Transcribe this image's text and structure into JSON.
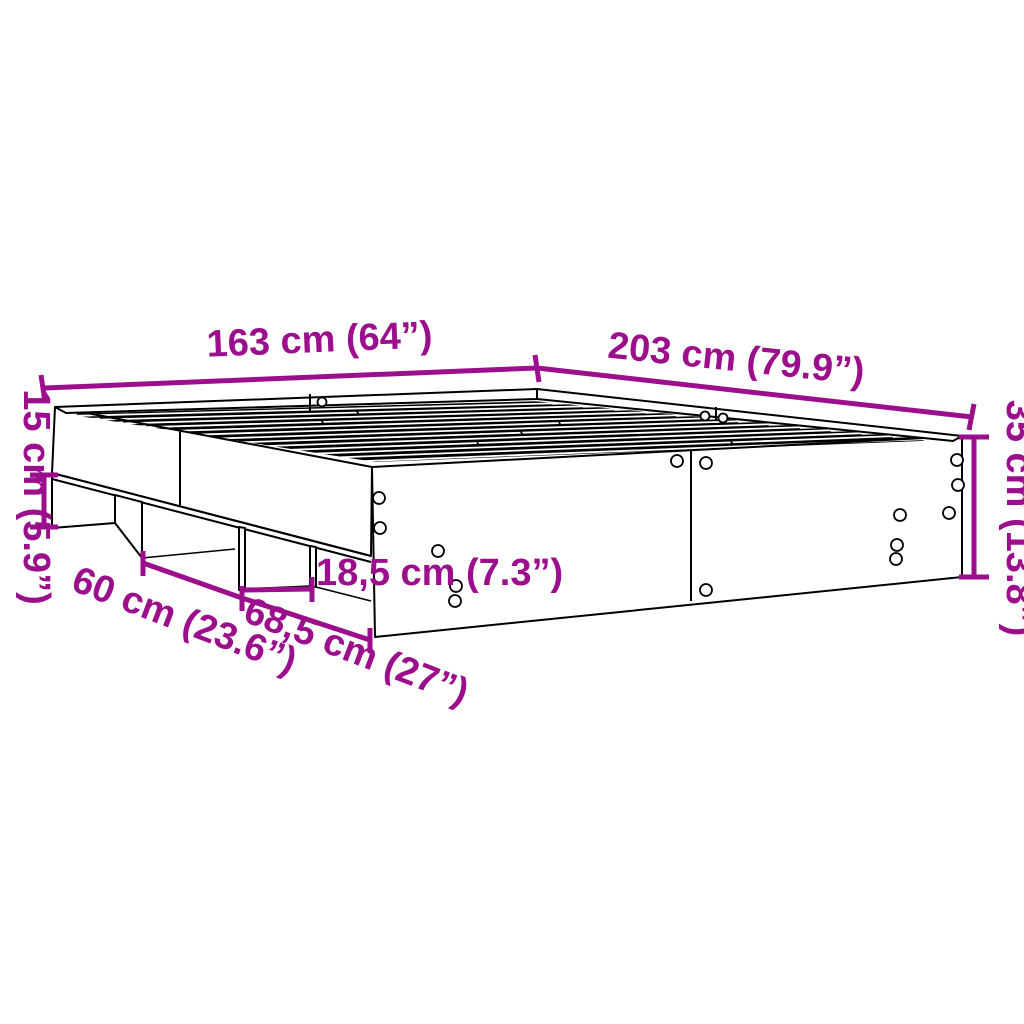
{
  "diagram": {
    "subject": "bed-frame-dimension-drawing",
    "background_color": "#FFFFFF",
    "line_color": "#000000",
    "dimension_color": "#9B0F8C",
    "dimensions": {
      "width": {
        "cm": "163",
        "in": "64",
        "label": "163 cm (64”)"
      },
      "length": {
        "cm": "203",
        "in": "79.9",
        "label": "203 cm (79.9”)"
      },
      "height": {
        "cm": "35",
        "in": "13.8",
        "label": "35 cm (13.8”)"
      },
      "base_height": {
        "cm": "15",
        "in": "5.9",
        "label": "15 cm (5.9”)"
      },
      "base_gap_width": {
        "cm": "60",
        "in": "23.6",
        "label": "60 cm (23.6”)"
      },
      "side_section": {
        "cm": "68,5",
        "in": "27",
        "label": "68,5 cm (27”)"
      },
      "small_gap": {
        "cm": "18,5",
        "in": "7.3",
        "label": "18,5 cm (7.3”)"
      }
    }
  }
}
